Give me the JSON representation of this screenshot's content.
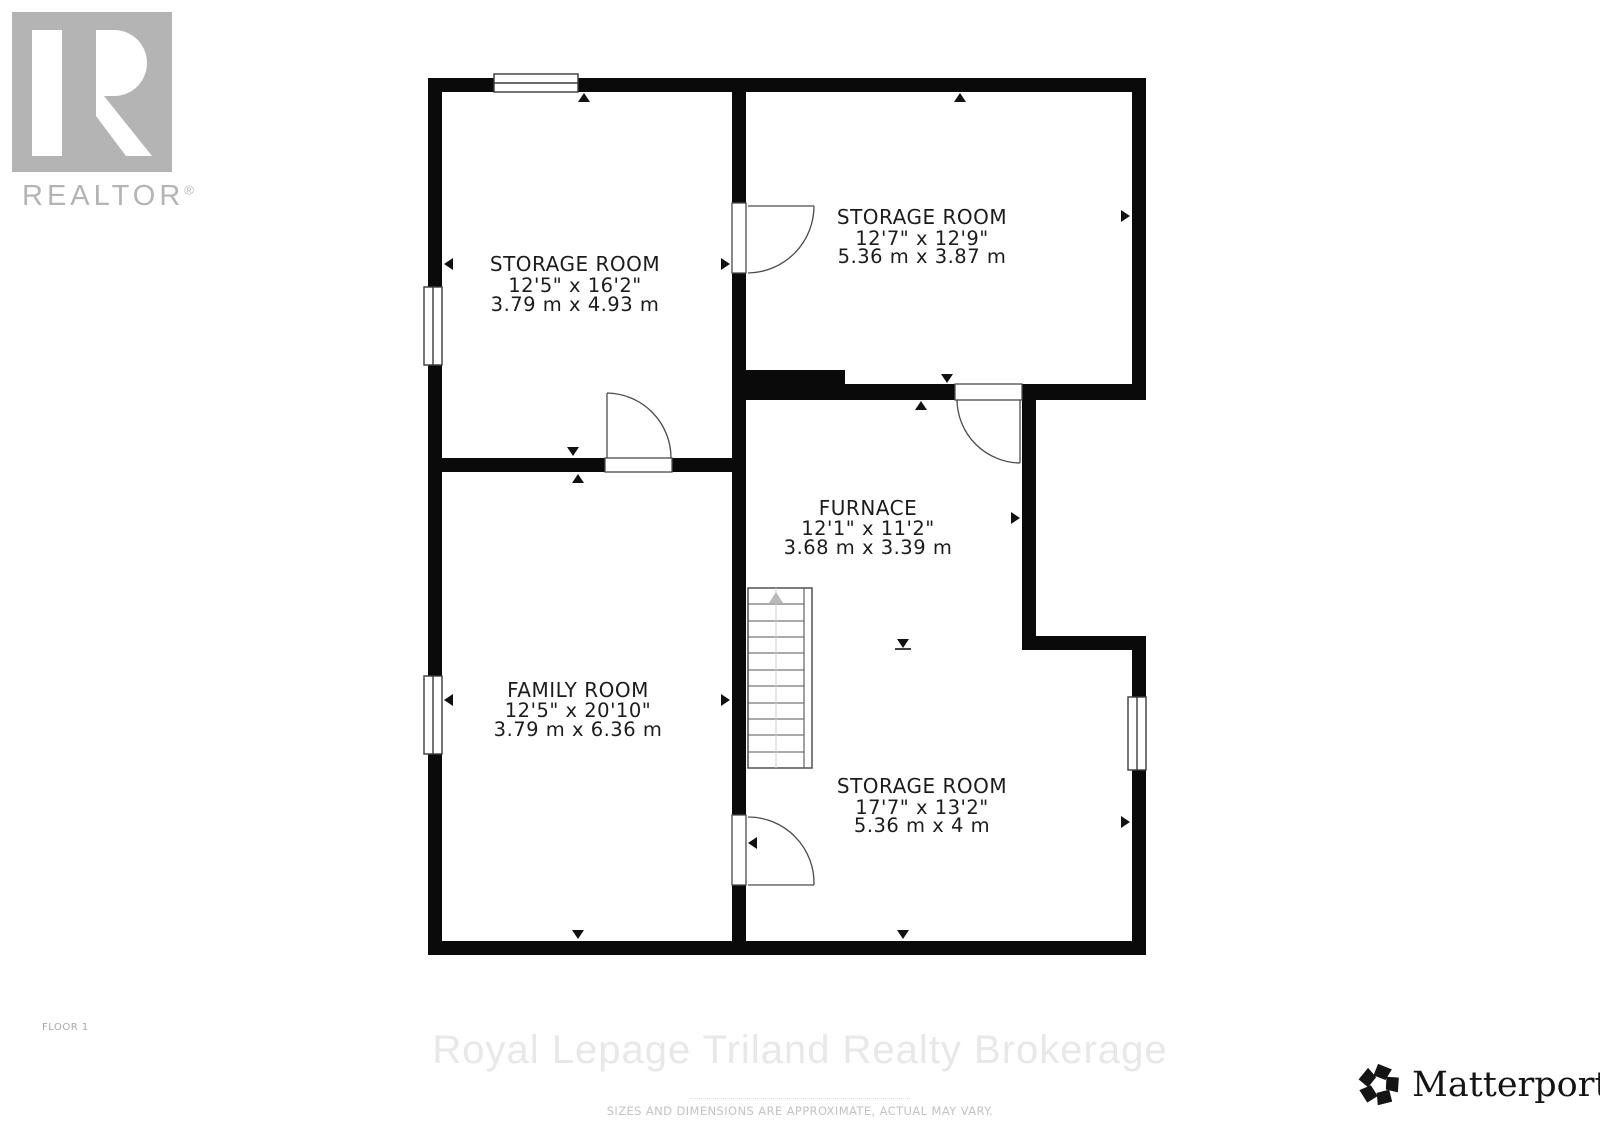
{
  "branding": {
    "realtor": {
      "label": "REALTOR",
      "reg": "®"
    },
    "matterport": {
      "label": "Matterport",
      "reg": "®"
    }
  },
  "rooms": [
    {
      "name": "STORAGE ROOM",
      "imperial": "12'5\" x 16'2\"",
      "metric": "3.79 m x 4.93 m"
    },
    {
      "name": "STORAGE ROOM",
      "imperial": "12'7\" x 12'9\"",
      "metric": "5.36 m x 3.87 m"
    },
    {
      "name": "FURNACE",
      "imperial": "12'1\" x 11'2\"",
      "metric": "3.68 m x 3.39 m"
    },
    {
      "name": "FAMILY ROOM",
      "imperial": "12'5\" x 20'10\"",
      "metric": "3.79 m x 6.36 m"
    },
    {
      "name": "STORAGE ROOM",
      "imperial": "17'7\" x 13'2\"",
      "metric": "5.36 m x 4 m"
    }
  ],
  "footer": {
    "floor_label": "FLOOR 1",
    "watermark": "Royal Lepage Triland Realty Brokerage",
    "disclaimer": "SIZES AND DIMENSIONS ARE APPROXIMATE, ACTUAL MAY VARY."
  },
  "colors": {
    "wall": "#0a0a0a",
    "label_text": "#1c1c1c",
    "logo_gray": "#b4b4b4",
    "watermark_gray": "#e8e8e8",
    "disclaimer_gray": "#c3c3c3"
  }
}
